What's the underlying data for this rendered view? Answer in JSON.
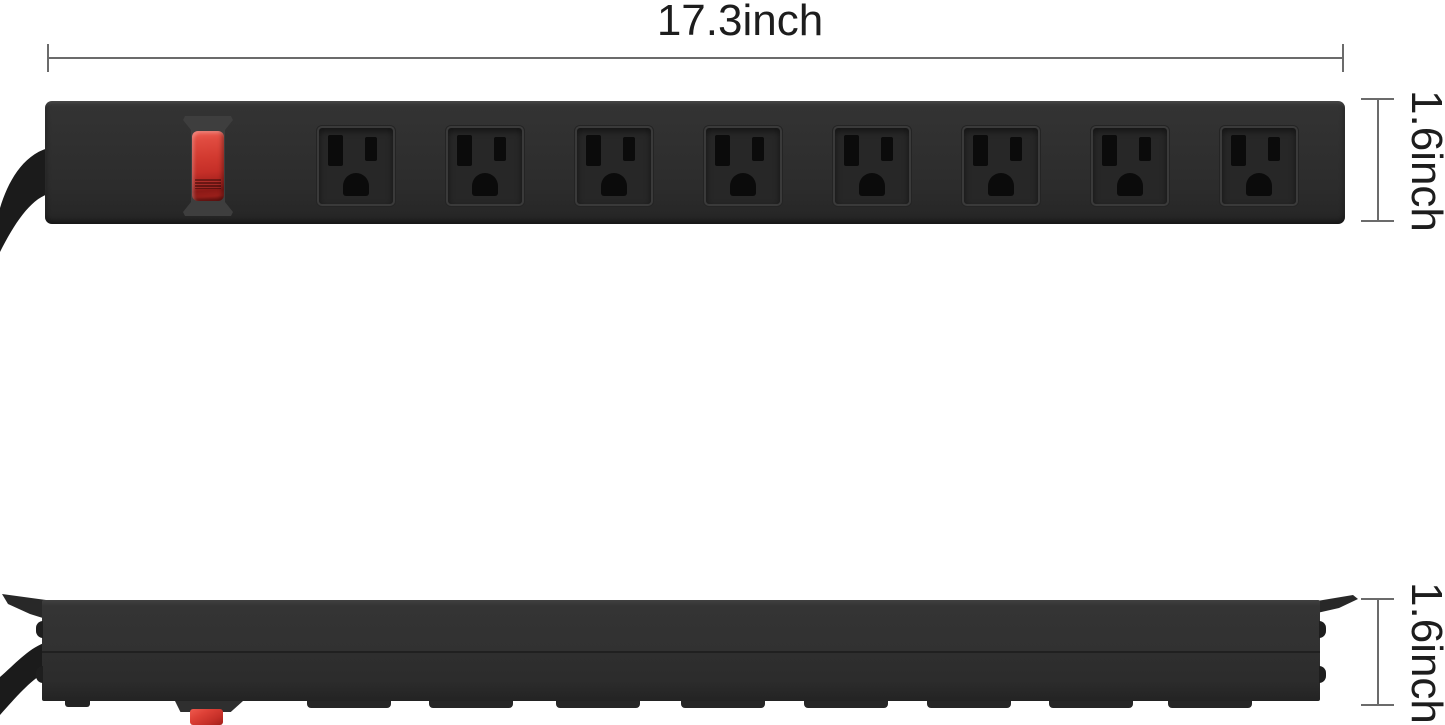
{
  "labels": {
    "width": "17.3inch",
    "front_height": "1.6inch",
    "side_height": "1.6inch"
  },
  "product": {
    "outlet_count": 8,
    "views": [
      "front",
      "side"
    ],
    "body_color": "#2e2e2e",
    "switch_color": "#cf3a31",
    "cord_color": "#1b1b1b",
    "slot_color": "#0b0b0b"
  },
  "style": {
    "background": "#ffffff",
    "dimension_line_color": "#6b6b6b",
    "label_color": "#1d1d1d"
  }
}
